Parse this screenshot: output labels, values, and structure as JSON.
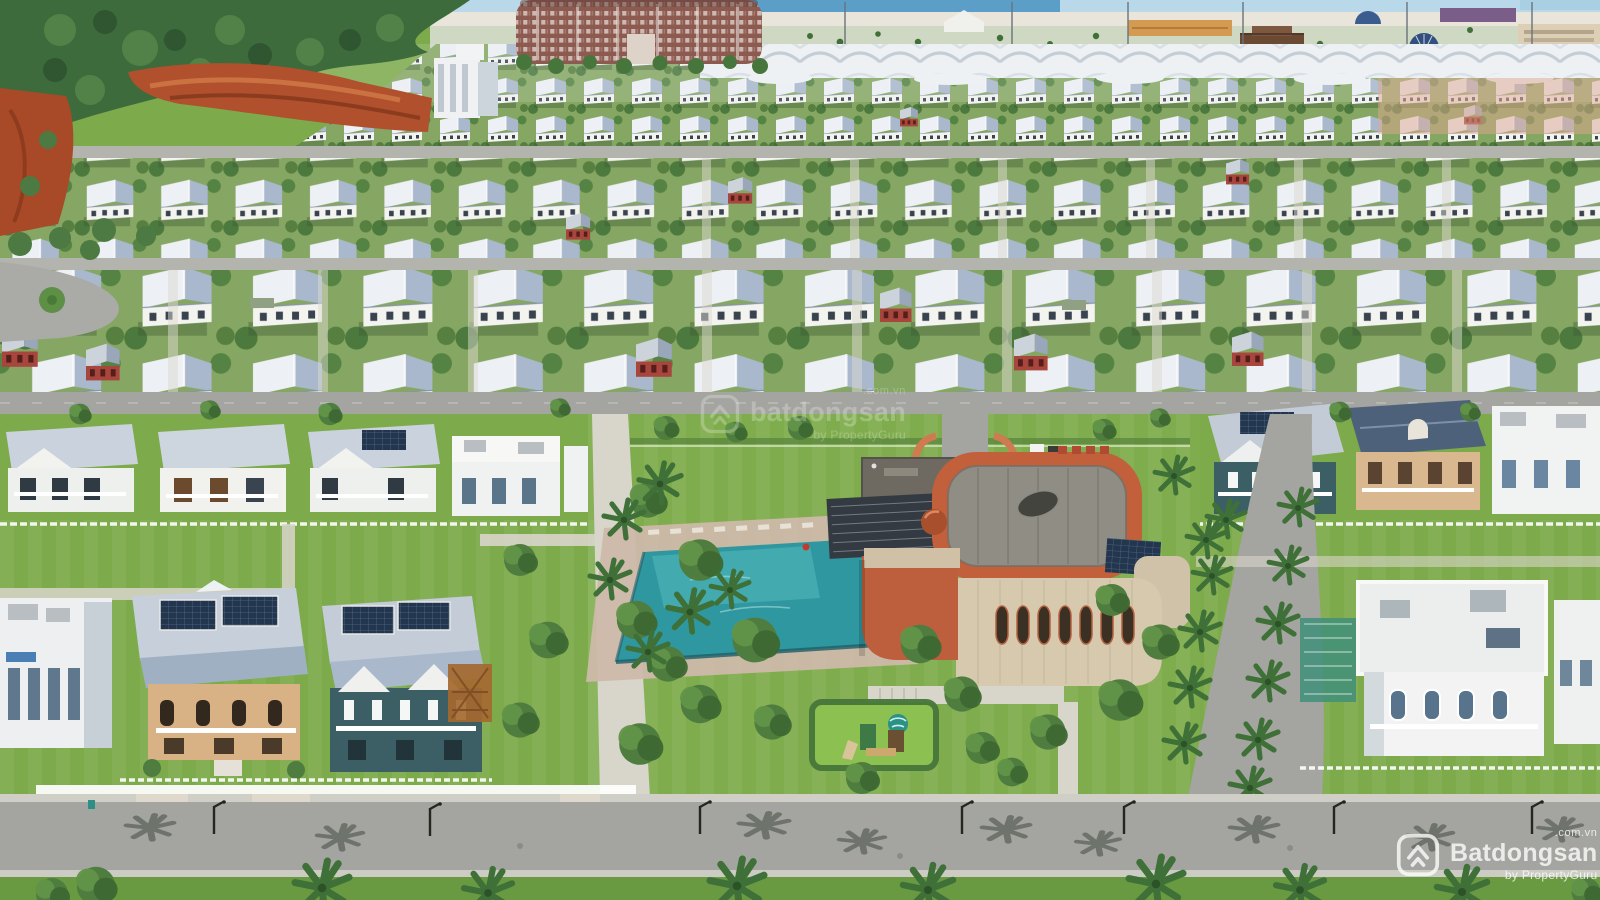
{
  "image": {
    "kind": "aerial-drone-photograph",
    "subject": "Coastal resort villa estate: dense rows of white villas with pale blue-gray roofs, central clubhouse with terracotta roof and swimming pool, palm-lined streets, beachfront amenities and ocean on the horizon",
    "width_px": 1600,
    "height_px": 900
  },
  "watermarks": {
    "center": {
      "brand": "batdongsan",
      "domain_suffix": ".com.vn",
      "byline": "by PropertyGuru"
    },
    "corner": {
      "brand": "Batdongsan",
      "domain_suffix": ".com.vn",
      "byline": "by PropertyGuru"
    }
  },
  "palette": {
    "sky": "#b9d9ea",
    "ocean": "#5b9ec7",
    "sand": "#e9e5da",
    "forest": "#3e6b3c",
    "cliff_red": "#b0502c",
    "grass": "#7dab4b",
    "lawn_bright": "#8cc152",
    "road": "#a4a4a1",
    "path": "#d8d5ca",
    "roof_light": "#edf0f5",
    "roof_shade": "#a9b8cc",
    "wall_white": "#f3f3ef",
    "pool_water": "#2f97a0",
    "pool_light": "#54bcbe",
    "clubhouse_terracotta": "#c2603c",
    "clubhouse_roof_gray": "#8f8d84",
    "clubhouse_wall_cream": "#d6c9ae",
    "condo_brick": "#8d5a50",
    "red_house": "#a8453c",
    "villa_tan": "#d8b184",
    "villa_teal": "#3c5f66",
    "solar_panel": "#24364d",
    "palm_green": "#3f7038",
    "tree_green": "#4f7d3f",
    "canopy_white": "#edf1f4"
  }
}
